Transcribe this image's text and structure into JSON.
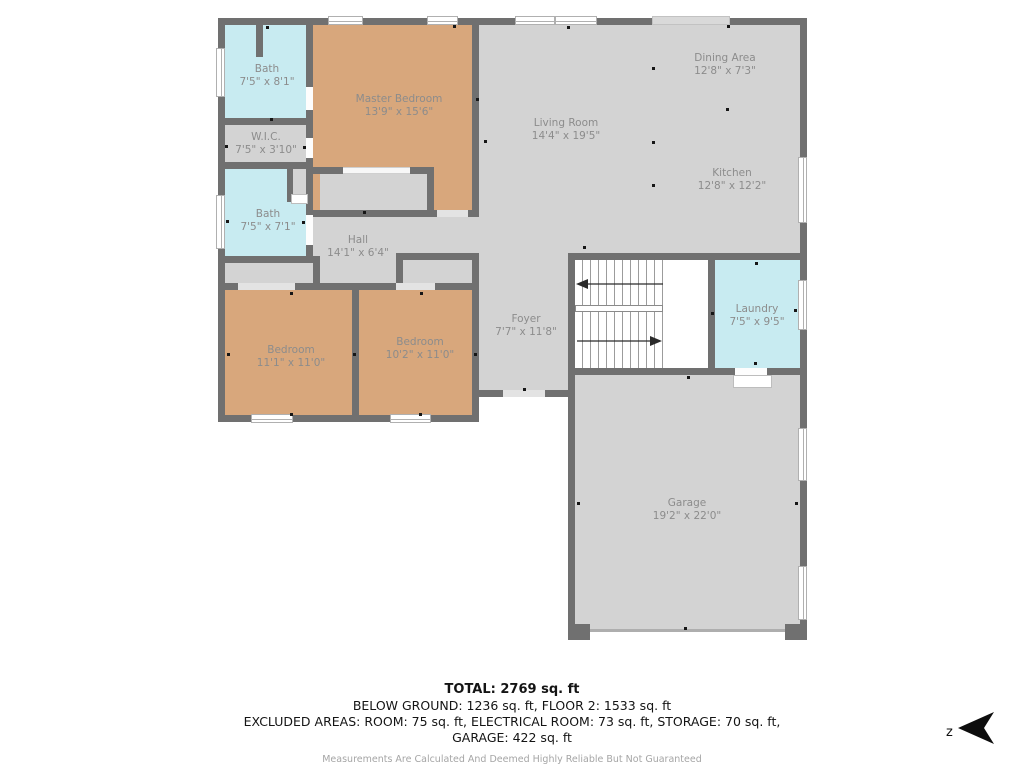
{
  "plan": {
    "rooms": {
      "bath1": {
        "name": "Bath",
        "dims": "7'5\" x 8'1\""
      },
      "master": {
        "name": "Master Bedroom",
        "dims": "13'9\" x 15'6\""
      },
      "wic": {
        "name": "W.I.C.",
        "dims": "7'5\" x 3'10\""
      },
      "bath2": {
        "name": "Bath",
        "dims": "7'5\" x 7'1\""
      },
      "hall": {
        "name": "Hall",
        "dims": "14'1\" x 6'4\""
      },
      "living": {
        "name": "Living Room",
        "dims": "14'4\" x 19'5\""
      },
      "dining": {
        "name": "Dining Area",
        "dims": "12'8\" x 7'3\""
      },
      "kitchen": {
        "name": "Kitchen",
        "dims": "12'8\" x 12'2\""
      },
      "foyer": {
        "name": "Foyer",
        "dims": "7'7\" x 11'8\""
      },
      "laundry": {
        "name": "Laundry",
        "dims": "7'5\" x 9'5\""
      },
      "bedroom1": {
        "name": "Bedroom",
        "dims": "11'1\" x 11'0\""
      },
      "bedroom2": {
        "name": "Bedroom",
        "dims": "10'2\" x 11'0\""
      },
      "garage": {
        "name": "Garage",
        "dims": "19'2\" x 22'0\""
      }
    },
    "footer": {
      "total": "TOTAL: 2769 sq. ft",
      "line2": "BELOW GROUND: 1236 sq. ft, FLOOR 2: 1533 sq. ft",
      "line3": "EXCLUDED AREAS: ROOM: 75 sq. ft, ELECTRICAL ROOM: 73 sq. ft, STORAGE: 70 sq. ft,",
      "line4": "GARAGE: 422 sq. ft",
      "disclaimer": "Measurements Are Calculated And Deemed Highly Reliable But Not Guaranteed"
    },
    "compass": {
      "label": "z"
    },
    "colors": {
      "wall": "#707070",
      "floor": "#d3d3d3",
      "bedroom_floor": "#d8a77c",
      "bath_floor": "#c8ebf1",
      "label_text": "#8c8c8c"
    }
  }
}
